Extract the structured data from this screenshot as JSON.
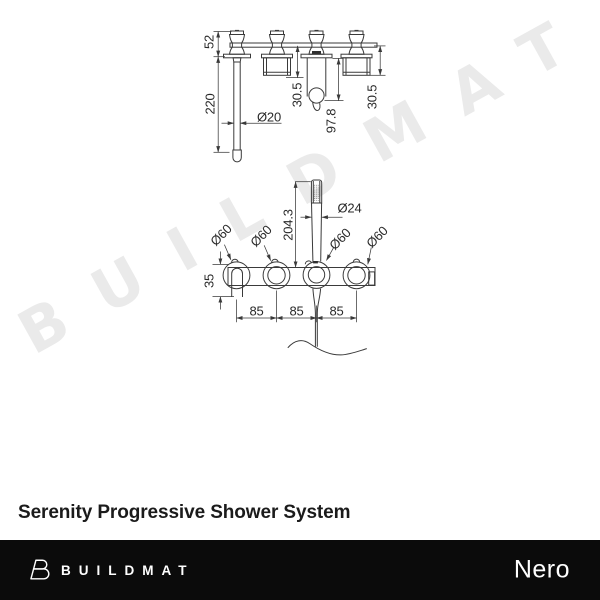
{
  "watermark": {
    "text": "BUILDMAT",
    "color": "#eaeaea"
  },
  "caption": {
    "title": "Serenity Progressive Shower System"
  },
  "footer": {
    "brand": "BUILDMAT",
    "partner_brand": "Nero",
    "background": "#0b0b0b"
  },
  "drawing": {
    "line_color": "#3a3a3a",
    "side_view": {
      "description": "side elevation of wall-mounted shower system",
      "dims": {
        "body_height": "52",
        "spout_length": "220",
        "spout_diameter": "Ø20",
        "handle_projection_left": "30.5",
        "holder_projection": "97.8",
        "handle_projection_right": "30.5"
      }
    },
    "front_view": {
      "description": "front elevation with hand shower",
      "dims": {
        "handshower_length": "204.3",
        "handshower_diameter": "Ø24",
        "flange_diameter_spout": "Ø60",
        "flange_diameter_handle1": "Ø60",
        "flange_diameter_holder": "Ø60",
        "flange_diameter_handle2": "Ø60",
        "spout_offset": "35",
        "centre_spacing_1": "85",
        "centre_spacing_2": "85",
        "centre_spacing_3": "85"
      }
    }
  }
}
